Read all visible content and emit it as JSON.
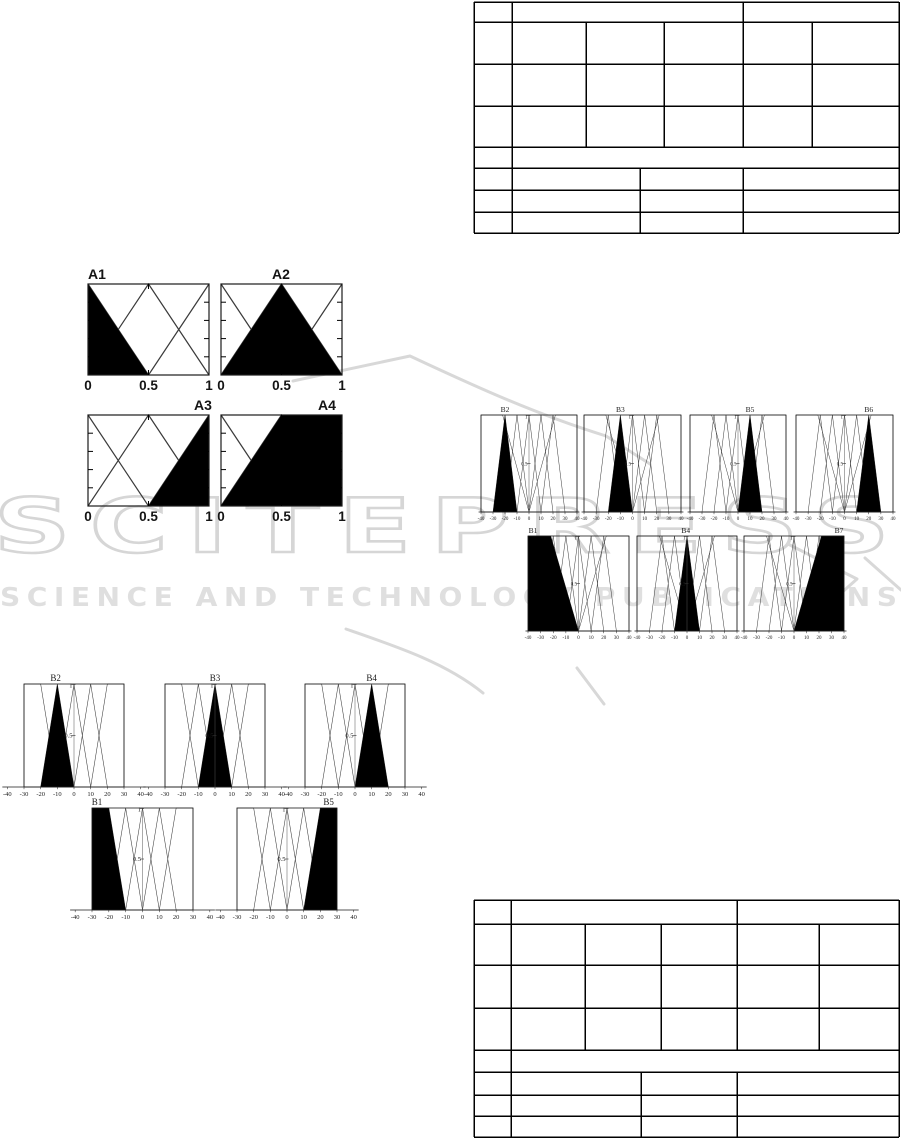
{
  "watermark": {
    "brand": "SCITEPRESS",
    "tagline": "SCIENCE AND TECHNOLOGY PUBLICATIONS",
    "outline_color": "#d6d6d6",
    "tagline_color": "#dfdfdf"
  },
  "tables": {
    "top": {
      "visible_text": [],
      "rows": 8,
      "note": "empty ruled table"
    },
    "bottom": {
      "visible_text": [],
      "rows": 8,
      "note": "empty ruled table"
    }
  },
  "chart_data": [
    {
      "id": "fig-inputs",
      "type": "line",
      "description": "Fuzzy membership functions of the inputs A1-A4",
      "xlim": [
        0,
        1
      ],
      "ylim": [
        0,
        1
      ],
      "x_ticks": [
        0,
        0.5,
        1
      ],
      "x_tick_labels": [
        "0",
        "0.5",
        "1"
      ],
      "grid": false,
      "mf_lines": [
        [
          [
            0,
            1
          ],
          [
            0.5,
            0
          ]
        ],
        [
          [
            0,
            0
          ],
          [
            0.5,
            1
          ],
          [
            1,
            0
          ]
        ],
        [
          [
            0.5,
            0
          ],
          [
            1,
            1
          ]
        ]
      ],
      "subplots": [
        {
          "label": "A1",
          "fill": [
            [
              0,
              0
            ],
            [
              0,
              1
            ],
            [
              0.5,
              0
            ]
          ]
        },
        {
          "label": "A2",
          "fill": [
            [
              0,
              0
            ],
            [
              0.5,
              1
            ],
            [
              1,
              0
            ]
          ]
        },
        {
          "label": "A3",
          "fill": [
            [
              0.5,
              0
            ],
            [
              1,
              1
            ],
            [
              1,
              0
            ]
          ]
        },
        {
          "label": "A4",
          "fill": [
            [
              0,
              0
            ],
            [
              0.5,
              1
            ],
            [
              1,
              1
            ],
            [
              1,
              0
            ]
          ]
        }
      ]
    },
    {
      "id": "fig-outputs-left",
      "type": "line",
      "description": "Fuzzy membership functions of output, partition with 5 sets B1-B5",
      "xlim": [
        -30,
        30
      ],
      "axis_range": [
        -43,
        43
      ],
      "ylim": [
        0,
        1
      ],
      "x_ticks": [
        -40,
        -30,
        -20,
        -10,
        0,
        10,
        20,
        30,
        40
      ],
      "x_tick_labels": [
        "-40",
        "-30",
        "-20",
        "-10",
        "0",
        "10",
        "20",
        "30",
        "40"
      ],
      "y_tick_labels": [
        "1",
        "0.5"
      ],
      "grid": false,
      "mf_lines": [
        [
          [
            -30,
            0
          ],
          [
            -30,
            1
          ],
          [
            -20,
            1
          ],
          [
            -10,
            0
          ]
        ],
        [
          [
            -20,
            0
          ],
          [
            -10,
            1
          ],
          [
            0,
            0
          ]
        ],
        [
          [
            -10,
            0
          ],
          [
            0,
            1
          ],
          [
            10,
            0
          ]
        ],
        [
          [
            0,
            0
          ],
          [
            10,
            1
          ],
          [
            20,
            0
          ]
        ],
        [
          [
            10,
            0
          ],
          [
            20,
            1
          ],
          [
            30,
            1
          ],
          [
            30,
            0
          ]
        ]
      ],
      "subplots": [
        {
          "label": "B2",
          "mf": 1,
          "title_x": -11
        },
        {
          "label": "B3",
          "mf": 2,
          "title_x": 0
        },
        {
          "label": "B4",
          "mf": 3,
          "title_x": 10
        },
        {
          "label": "B1",
          "mf": 0,
          "title_x": -27
        },
        {
          "label": "B5",
          "mf": 4,
          "title_x": 25
        }
      ]
    },
    {
      "id": "fig-outputs-right",
      "type": "line",
      "description": "Fuzzy membership functions of output, partition with 7 sets B1-B7",
      "xlim": [
        -40,
        40
      ],
      "axis_range": [
        -42,
        42
      ],
      "ylim": [
        0,
        1
      ],
      "x_ticks": [
        -40,
        -30,
        -20,
        -10,
        0,
        10,
        20,
        30,
        40
      ],
      "x_tick_labels": [
        "-40",
        "-30",
        "-20",
        "-10",
        "0",
        "10",
        "20",
        "30",
        "40"
      ],
      "y_tick_labels": [
        "1",
        "0.5"
      ],
      "grid": false,
      "mf_lines": [
        [
          [
            -40,
            0
          ],
          [
            -40,
            1
          ],
          [
            -22,
            1
          ],
          [
            0,
            0
          ]
        ],
        [
          [
            -30,
            0
          ],
          [
            -20,
            1
          ],
          [
            -10,
            0
          ]
        ],
        [
          [
            -20,
            0
          ],
          [
            -10,
            1
          ],
          [
            0,
            0
          ]
        ],
        [
          [
            -10,
            0
          ],
          [
            0,
            1
          ],
          [
            10,
            0
          ]
        ],
        [
          [
            0,
            0
          ],
          [
            10,
            1
          ],
          [
            20,
            0
          ]
        ],
        [
          [
            10,
            0
          ],
          [
            20,
            1
          ],
          [
            30,
            0
          ]
        ],
        [
          [
            0,
            0
          ],
          [
            22,
            1
          ],
          [
            40,
            1
          ],
          [
            40,
            0
          ]
        ]
      ],
      "subplots": [
        {
          "label": "B2",
          "mf": 1,
          "title_x": -20
        },
        {
          "label": "B3",
          "mf": 2,
          "title_x": -10
        },
        {
          "label": "B5",
          "mf": 4,
          "title_x": 10
        },
        {
          "label": "B6",
          "mf": 5,
          "title_x": 20
        },
        {
          "label": "B1",
          "mf": 0,
          "title_x": -36
        },
        {
          "label": "B4",
          "mf": 3,
          "title_x": -1
        },
        {
          "label": "B7",
          "mf": 6,
          "title_x": 36
        }
      ]
    }
  ]
}
